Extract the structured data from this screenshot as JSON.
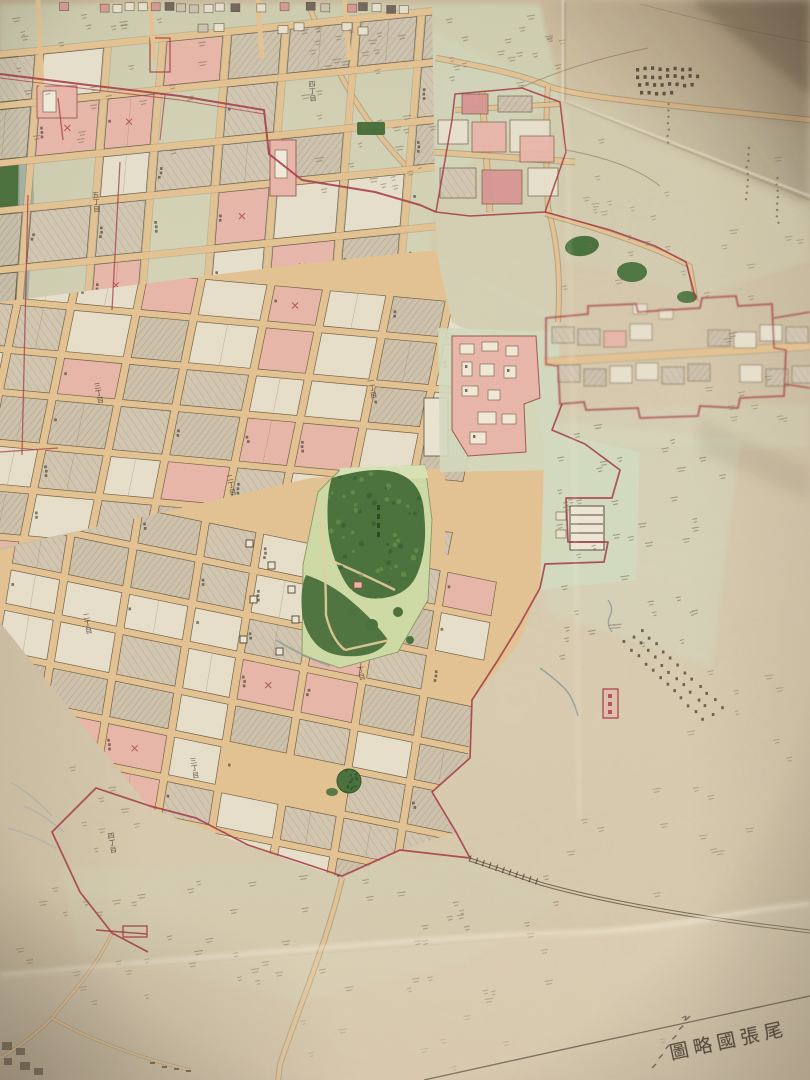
{
  "title": {
    "text": "尾張國略圖",
    "display_rtl": "圖略國張尾"
  },
  "map": {
    "street_labels": [
      "一丁目",
      "二丁目",
      "三丁目",
      "四丁目",
      "五丁目",
      "六丁目"
    ],
    "colors": {
      "paper": "#d7c9ad",
      "paper_light": "#e8ddc6",
      "paper_dark": "#9e8769",
      "street": "#e5c493",
      "street_edge": "#8a7154",
      "block_cream": "#e9e2cf",
      "block_hatch": "#cec3af",
      "hatch_line": "#b2a289",
      "pink": "#eab7ab",
      "pink_deep": "#d89693",
      "red": "#a63a46",
      "park_dark": "#49713b",
      "park_deep": "#2f5426",
      "park_light": "#cfdca6",
      "tint_green": "#d4dcc0",
      "water": "#9cab9f",
      "ink": "#453b2f",
      "mark": "#3a332a",
      "rail": "#5f5342"
    }
  }
}
